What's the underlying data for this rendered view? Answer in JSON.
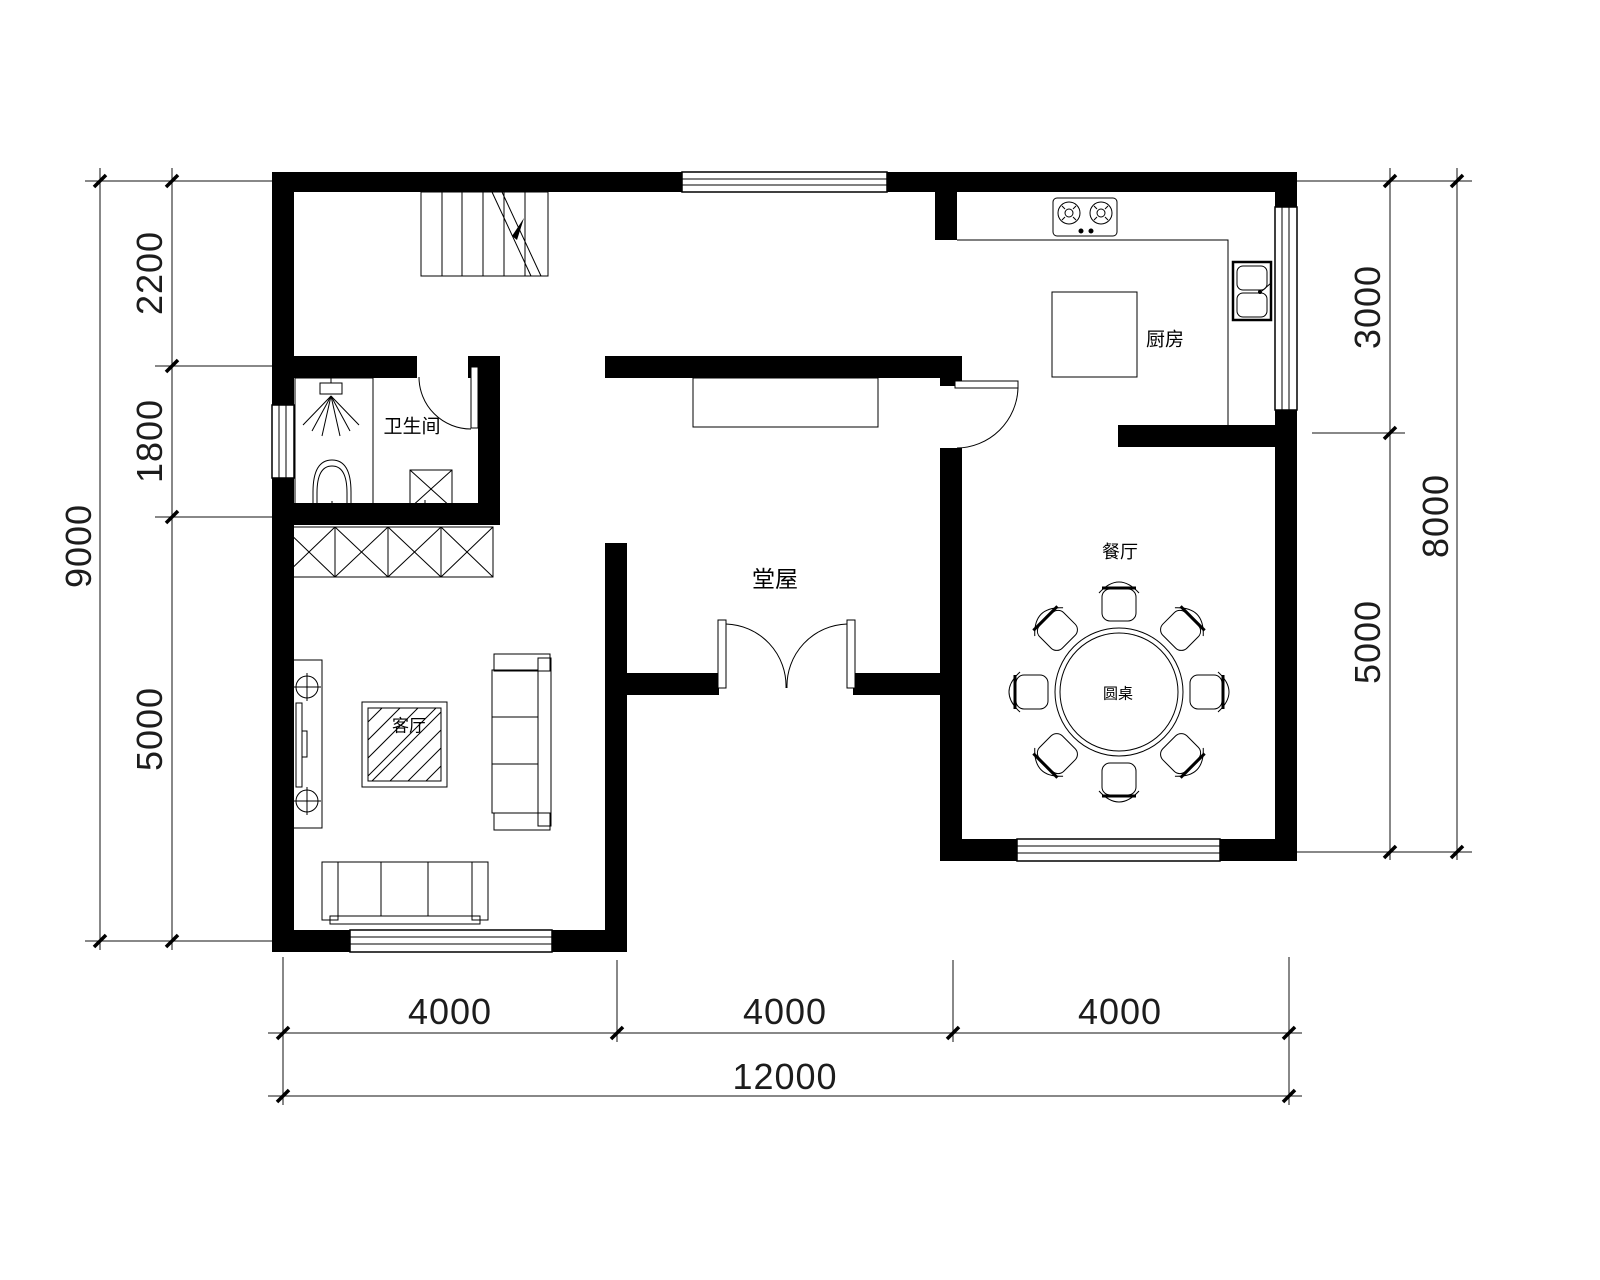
{
  "rooms": {
    "bathroom": "卫生间",
    "kitchen": "厨房",
    "hall": "堂屋",
    "dining": "餐厅",
    "living": "客厅",
    "round_table": "圆桌"
  },
  "dims": {
    "left_outer": "9000",
    "left": [
      "2200",
      "1800",
      "5000"
    ],
    "right": [
      "3000",
      "5000"
    ],
    "right_outer": "8000",
    "bottom": [
      "4000",
      "4000",
      "4000"
    ],
    "bottom_outer": "12000"
  },
  "colors": {
    "wall": "#000000",
    "line": "#000000",
    "background": "#ffffff"
  }
}
